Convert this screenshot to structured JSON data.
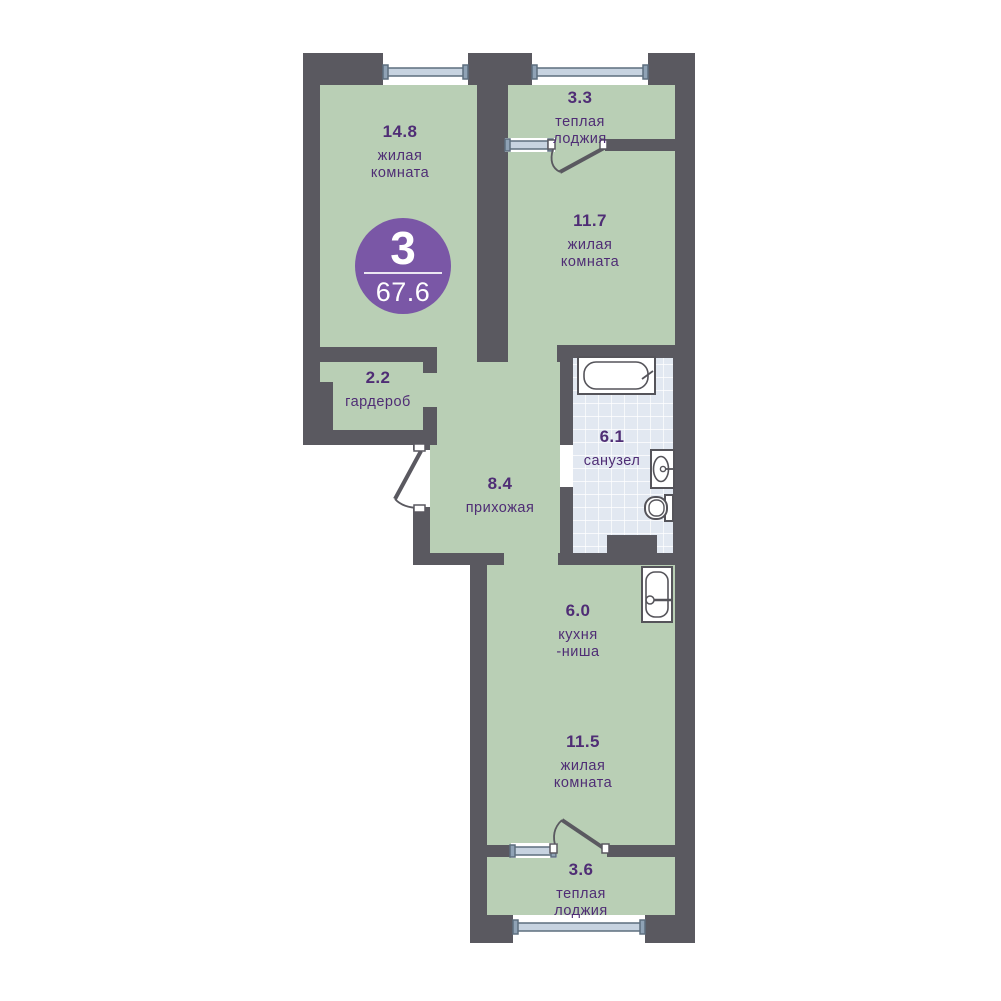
{
  "floorplan": {
    "badge": {
      "rooms_count": "3",
      "total_area": "67.6"
    },
    "rooms": [
      {
        "area": "14.8",
        "line1": "жилая",
        "line2": "комната"
      },
      {
        "area": "3.3",
        "line1": "теплая",
        "line2": "лоджия"
      },
      {
        "area": "11.7",
        "line1": "жилая",
        "line2": "комната"
      },
      {
        "area": "2.2",
        "line1": "гардероб",
        "line2": ""
      },
      {
        "area": "8.4",
        "line1": "прихожая",
        "line2": ""
      },
      {
        "area": "6.1",
        "line1": "санузел",
        "line2": ""
      },
      {
        "area": "6.0",
        "line1": "кухня",
        "line2": "-ниша"
      },
      {
        "area": "11.5",
        "line1": "жилая",
        "line2": "комната"
      },
      {
        "area": "3.6",
        "line1": "теплая",
        "line2": "лоджия"
      }
    ],
    "colors": {
      "wall": "#5a5960",
      "room_fill": "#b9cfb5",
      "bathroom_tile": "#e2e8f1",
      "accent_purple": "#7a57a6",
      "label_purple": "#4f2d75",
      "window_bar": "#c7d3e0"
    },
    "icons": {
      "bathtub": "bathtub-icon",
      "bathroom_sink": "sink-icon",
      "toilet": "toilet-icon",
      "kitchen_sink": "kitchen-sink-icon"
    }
  }
}
